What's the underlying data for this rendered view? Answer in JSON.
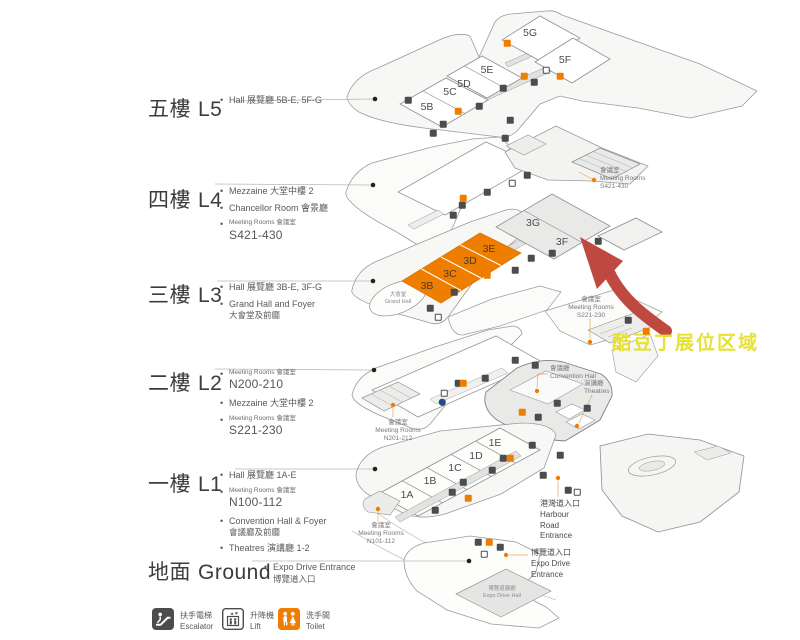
{
  "colors": {
    "highlight_orange": "#ef7d00",
    "arrow_red": "#bf4940",
    "annotation_yellow": "#e6e134"
  },
  "floors": [
    {
      "zh": "五樓",
      "en": "L5",
      "bullets": [
        {
          "text": "Hall 展覽廳 5B-E, 5F-G"
        }
      ]
    },
    {
      "zh": "四樓",
      "en": "L4",
      "bullets": [
        {
          "text": "Mezzaine 大堂中樓 2"
        },
        {
          "text": "Chancellor Room  會景廳"
        },
        {
          "small": "Meeting Rooms  會議室",
          "rooms": "S421-430"
        }
      ]
    },
    {
      "zh": "三樓",
      "en": "L3",
      "bullets": [
        {
          "text": "Hall 展覽廳 3B-E, 3F-G"
        },
        {
          "text": "Grand Hall and Foyer",
          "sub": "大會堂及前廳"
        }
      ]
    },
    {
      "zh": "二樓",
      "en": "L2",
      "bullets": [
        {
          "small": "Meeting Rooms  會議室",
          "rooms": "N200-210"
        },
        {
          "text": "Mezzaine 大堂中樓 2"
        },
        {
          "small": "Meeting Rooms  會議室",
          "rooms": "S221-230"
        }
      ]
    },
    {
      "zh": "一樓",
      "en": "L1",
      "bullets": [
        {
          "text": "Hall 展覽廳 1A-E"
        },
        {
          "small": "Meeting Rooms  會議室",
          "rooms": "N100-112"
        },
        {
          "text": "Convention Hall & Foyer",
          "sub": "會議廳及前廳"
        },
        {
          "text": "Theatres  演講廳 1-2"
        }
      ]
    },
    {
      "zh": "地面",
      "en": "Ground",
      "bullets": [
        {
          "text": "Expo Drive Entrance",
          "sub": "博覽道入口"
        }
      ]
    }
  ],
  "halls": {
    "l5": [
      "5B",
      "5C",
      "5D",
      "5E",
      "5G",
      "5F"
    ],
    "l3": [
      "3B",
      "3C",
      "3D",
      "3E",
      "3G",
      "3F"
    ],
    "l1": [
      "1A",
      "1B",
      "1C",
      "1D",
      "1E"
    ]
  },
  "map_labels": {
    "s421": {
      "zh": "會議室",
      "en": "Meeting Rooms",
      "rooms": "S421-430"
    },
    "s221": {
      "zh": "會議室",
      "en": "Meeting Rooms",
      "rooms": "S221-230"
    },
    "n201": {
      "zh": "會議室",
      "en": "Meeting Rooms",
      "rooms": "N201-212"
    },
    "n101": {
      "zh": "會議室",
      "en": "Meeting Rooms",
      "rooms": "N101-112"
    },
    "convention_hall": {
      "zh": "會議廳",
      "en": "Convention Hall"
    },
    "theatres": {
      "zh": "演講廳",
      "en": "Theatres"
    },
    "harbour": {
      "zh": "港灣道入口",
      "en1": "Harbour",
      "en2": "Road",
      "en3": "Entrance"
    },
    "expo_entrance": {
      "zh": "博覽道入口",
      "en1": "Expo Drive",
      "en2": "Entrance"
    },
    "grand_hall": {
      "zh": "大會堂",
      "en": "Grand Hall"
    },
    "expo_hall": {
      "zh": "博覽道展廳",
      "en": "Expo Drive Hall"
    }
  },
  "annotation": {
    "text": "酷豆丁展位区域"
  },
  "legend": [
    {
      "zh": "扶手電梯",
      "en": "Escalator"
    },
    {
      "zh": "升降機",
      "en": "Lift"
    },
    {
      "zh": "洗手間",
      "en": "Toilet"
    }
  ]
}
